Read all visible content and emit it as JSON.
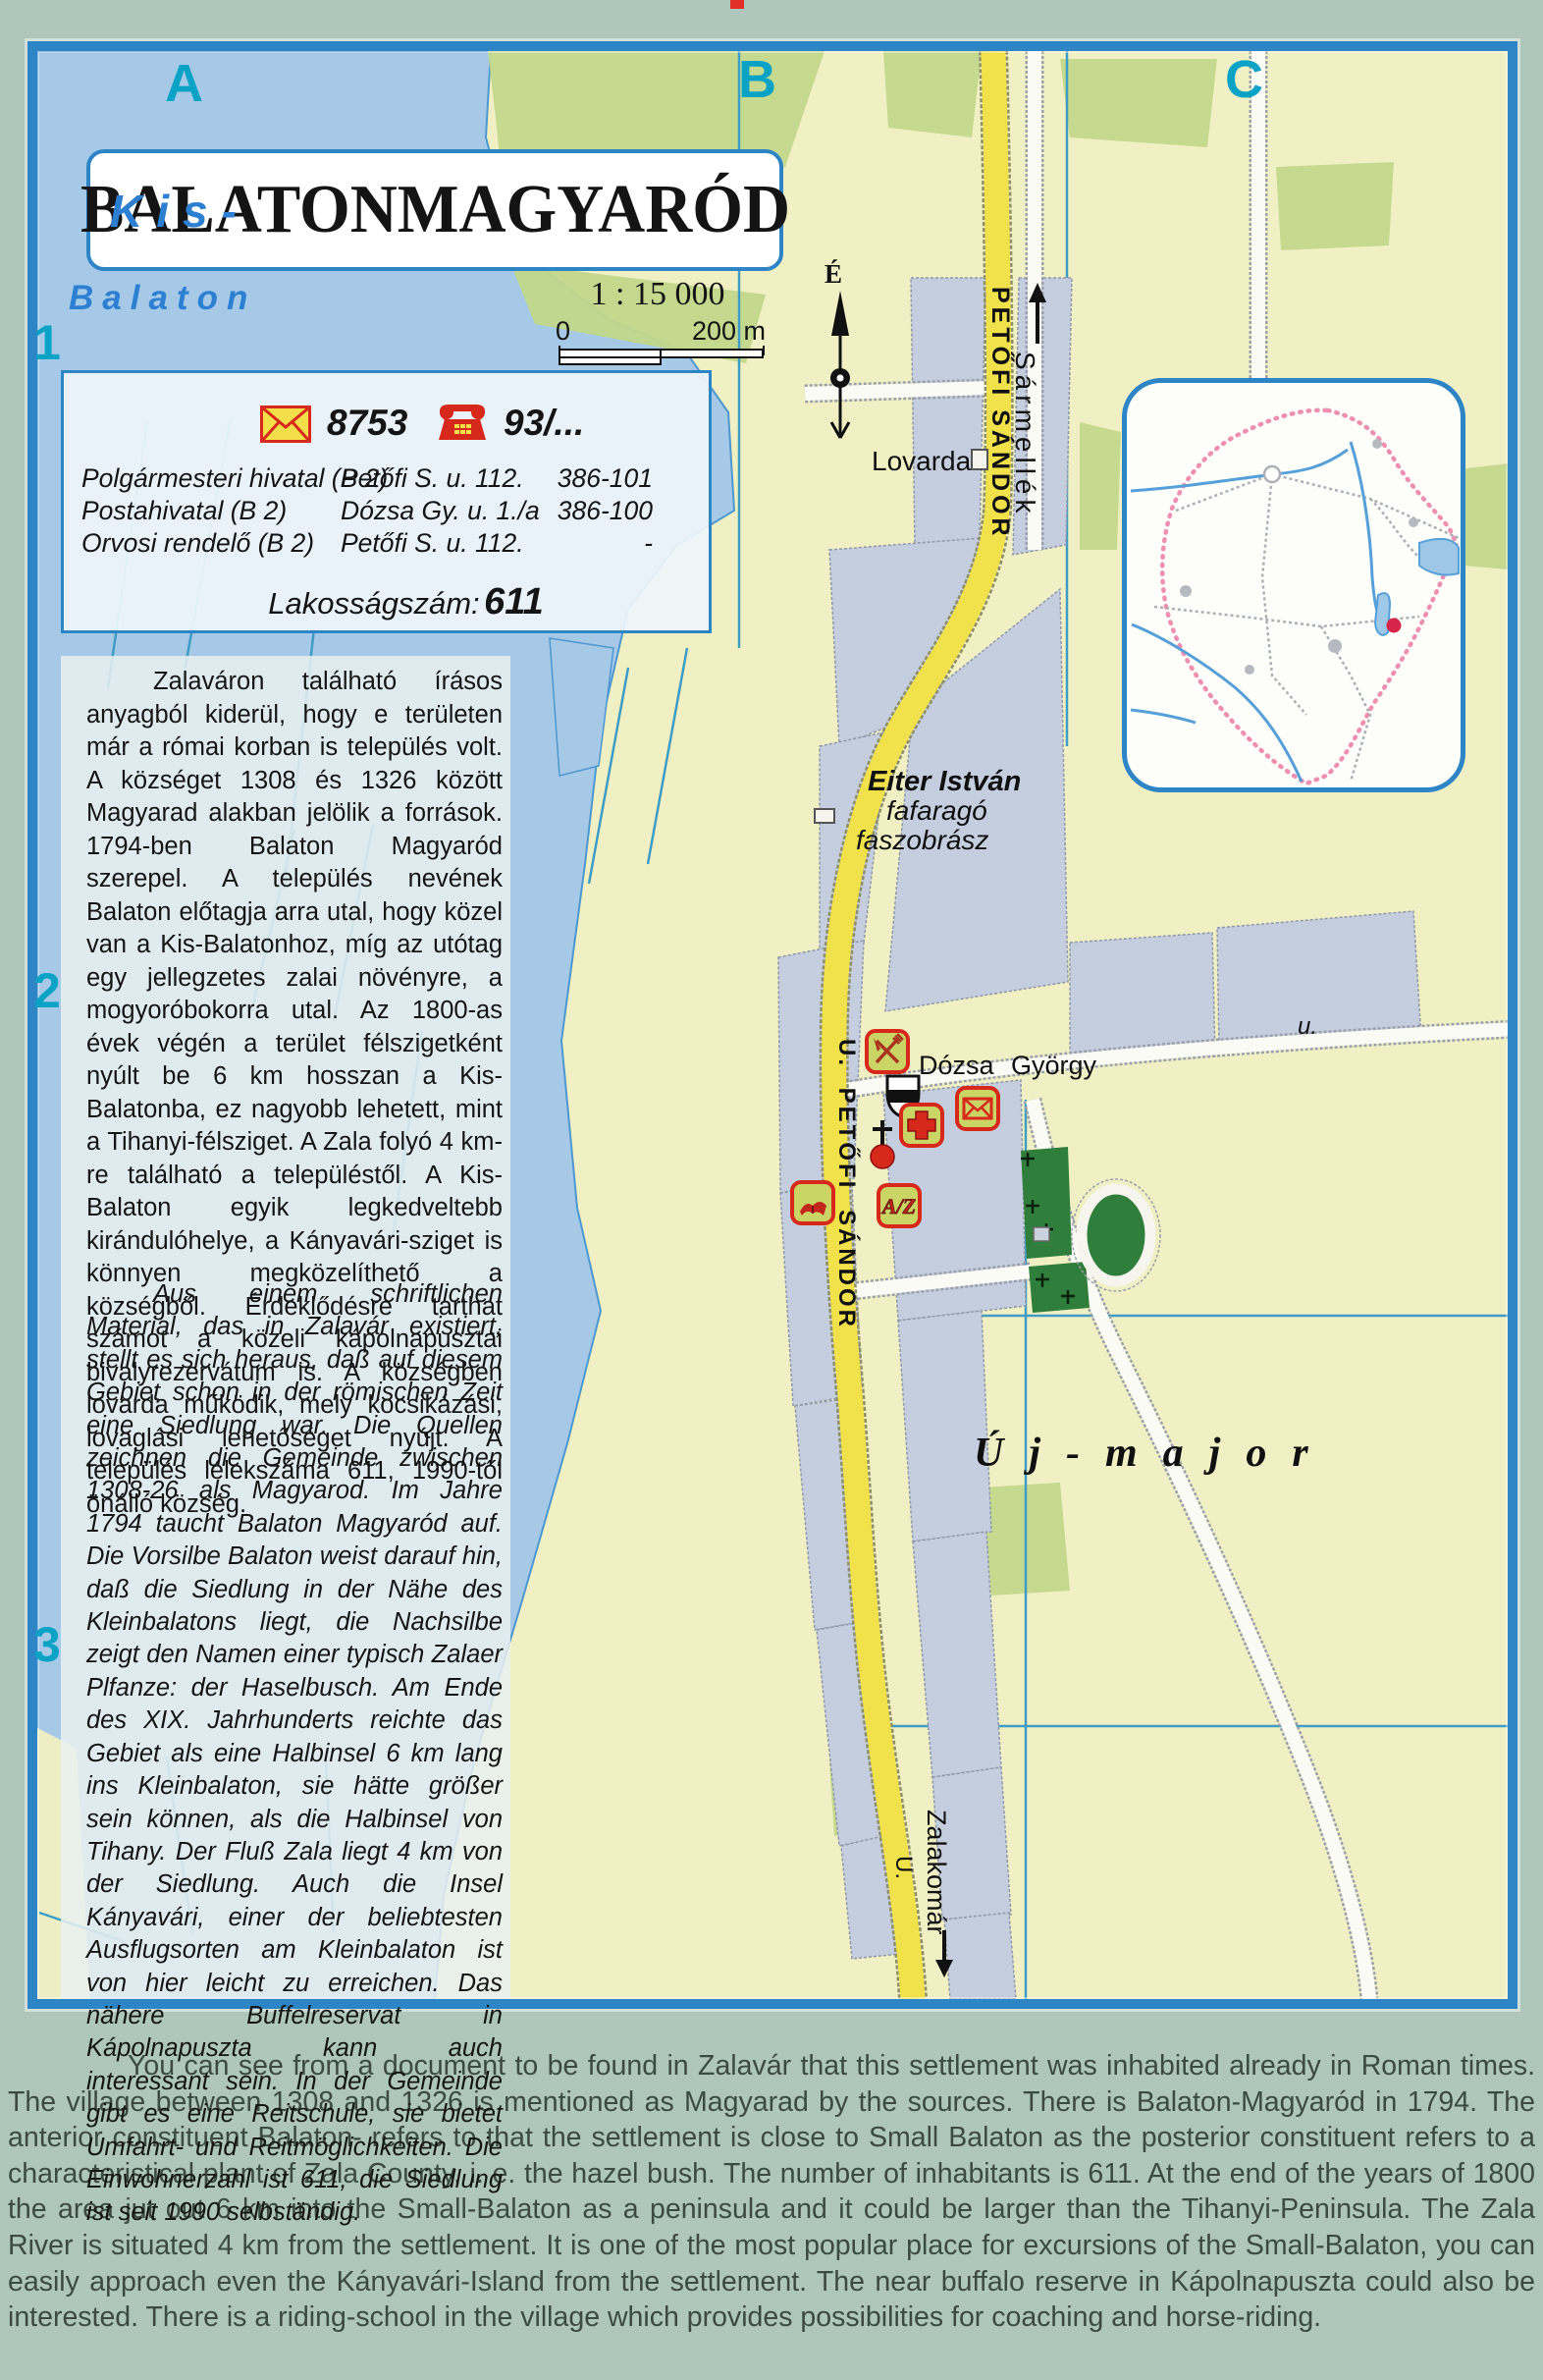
{
  "map": {
    "title": "BALATONMAGYARÓD",
    "scale_text": "1 : 15 000",
    "scale_zero": "0",
    "scale_end": "200 m",
    "north_label": "É",
    "grid_columns": [
      "A",
      "B",
      "C"
    ],
    "grid_rows": [
      "1",
      "2",
      "3"
    ],
    "water_label_line1": "Kis-",
    "water_label_line2": "Balaton"
  },
  "info_box": {
    "postal_code": "8753",
    "phone_code": "93/...",
    "rows": [
      {
        "name": "Polgármesteri hivatal (B 2)",
        "address": "Petőfi S. u. 112.",
        "phone": "386-101"
      },
      {
        "name": "Postahivatal (B 2)",
        "address": "Dózsa Gy. u. 1./a",
        "phone": "386-100"
      },
      {
        "name": "Orvosi rendelő (B 2)",
        "address": "Petőfi S. u. 112.",
        "phone": "-"
      }
    ],
    "population_label": "Lakosságszám:",
    "population_value": "611"
  },
  "labels": {
    "lovarda": "Lovarda",
    "sarmellek": "Sármellék",
    "petofi_top": "PETŐFI SÁNDOR",
    "petofi_mid": "U. PETŐFI SÁNDOR",
    "eiter_line1": "Eiter István",
    "eiter_line2": "fafaragó",
    "eiter_line3": "faszobrász",
    "dozsa": "Dózsa György",
    "dozsa_u": "u.",
    "uj_major": "Új-major",
    "zalakomar": "Zalakomár",
    "zalakomar_u": "U."
  },
  "icons": {
    "az_text": "A/Z"
  },
  "paragraphs": {
    "hungarian": "Zalaváron található írásos anyagból kiderül, hogy e területen már a római korban is település volt. A községet 1308 és 1326 között Magyarad alakban jelölik a források. 1794-ben Balaton Magyaród szerepel. A település nevének Balaton előtagja arra utal, hogy közel van a Kis-Balatonhoz, míg az utótag egy jellegzetes zalai növényre, a mogyoróbokorra utal. Az 1800-as évek végén a terület félszigetként nyúlt be 6 km hosszan a Kis-Balatonba, ez nagyobb lehetett, mint a Tihanyi-félsziget. A Zala folyó 4 km-re található a településtől. A Kis-Balaton egyik legkedveltebb kirándulóhelye, a Kányavári-sziget is könnyen megközelíthető a községből. Érdeklődésre tarthat számot a közeli kápolnapusztai bivalyrezervátum is. A községben lovarda működik, mely kocsikázási, lovaglási lehetőséget nyújt. A település lélekszáma 611, 1990-től önálló község.",
    "german": "Aus einem schriftlichen Material, das in Zalavár existiert, stellt es sich heraus, daß auf diesem Gebiet schon in der römischen Zeit eine Siedlung war. Die Quellen zeichnen die Gemeinde zwischen 1308-26 als Magyarod. Im Jahre 1794 taucht Balaton Magyaród auf. Die Vorsilbe Balaton weist darauf hin, daß die Siedlung in der Nähe des Kleinbalatons liegt, die Nachsilbe zeigt den Namen einer typisch Zalaer Plfanze: der Haselbusch. Am Ende des XIX. Jahrhunderts reichte das Gebiet als eine Halbinsel 6 km lang ins Kleinbalaton, sie hätte größer sein können, als die Halbinsel von Tihany. Der Fluß Zala liegt 4 km von der Siedlung. Auch die Insel Kányavári, einer der beliebtesten Ausflugsorten am Kleinbalaton ist von hier leicht zu erreichen. Das nähere Buffelreservat in Kápolnapuszta kann auch interessant sein. In der Gemeinde gibt es eine Reitschule, sie bietet Umfahrt- und Reitmöglichkeiten. Die Einwohnerzahl ist 611, die Siedlung ist seit 1990 selbständig.",
    "english": "You can see from a document to be found in Zalavár that this settlement was inhabited already in Roman times. The village between 1308 and 1326 is mentioned as Magyarad by the sources. There is Balaton-Magyaród in 1794. The anterior constituent Balaton- refers to that the settlement is close to Small Balaton as the posterior constituent refers to a characteristical plant of Zala County, i. e. the hazel bush. The number of inhabitants is 611. At the end of the years of 1800 the area jut out 6 km into the Small-Balaton as a peninsula and it could be larger than the Tihanyi-Peninsula. The Zala River is situated 4 km from the settlement. It is one of the most popular place for excursions of the Small-Balaton, you can easily approach even the Kányavári-Island from the settlement. The near buffalo reserve in Kápolnapuszta could also be interested. There is a riding-school in the village which provides possibilities for coaching and horse-riding."
  },
  "colors": {
    "frame_blue": "#2e85c6",
    "water": "#a6c9e8",
    "land": "#f1f0c4",
    "built_up": "#c4cedf",
    "road_yellow": "#f1e24b",
    "grid_label_cyan": "#0aa2c5",
    "symbol_red": "#d7281c",
    "symbol_bg": "#cbd566"
  }
}
